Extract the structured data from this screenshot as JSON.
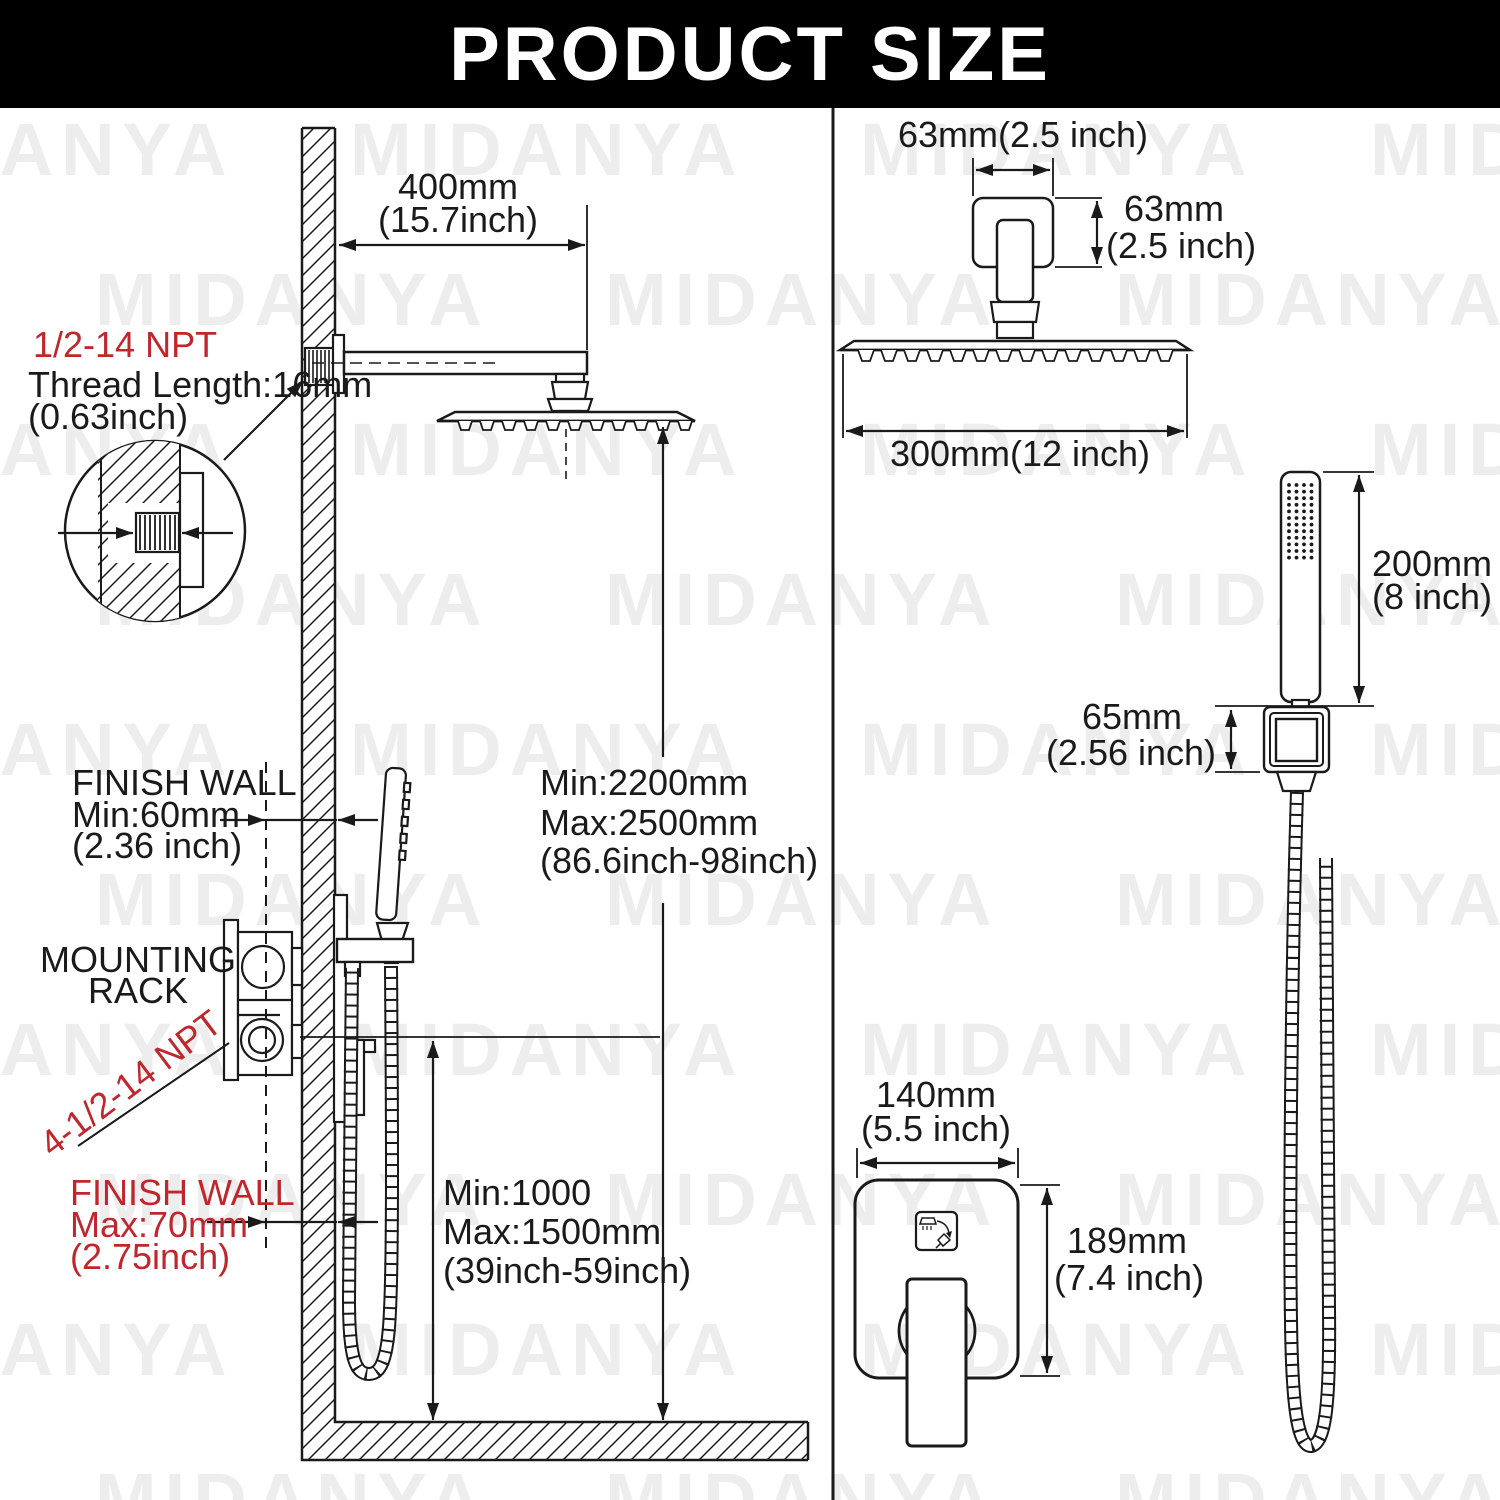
{
  "title": "PRODUCT SIZE",
  "watermark": "MIDANYA",
  "colors": {
    "banner": "#000000",
    "line": "#1a1a1a",
    "red": "#c0272d",
    "watermark": "#ededed"
  },
  "left_panel": {
    "npt_top_label": "1/2-14 NPT",
    "thread_length_line1": "Thread Length:16mm",
    "thread_length_line2": "(0.63inch)",
    "arm_length_line1": "400mm",
    "arm_length_line2": "(15.7inch)",
    "finish_wall_min_line1": "FINISH WALL",
    "finish_wall_min_line2": "Min:60mm",
    "finish_wall_min_line3": "(2.36 inch)",
    "mounting_rack_line1": "MOUNTING",
    "mounting_rack_line2": "RACK",
    "npt_bottom_label": "4-1/2-14 NPT",
    "finish_wall_max_line1": "FINISH WALL",
    "finish_wall_max_line2": "Max:70mm",
    "finish_wall_max_line3": "(2.75inch)",
    "head_height_line1": "Min:2200mm",
    "head_height_line2": "Max:2500mm",
    "head_height_line3": "(86.6inch-98inch)",
    "valve_height_line1": "Min:1000",
    "valve_height_line2": "Max:1500mm",
    "valve_height_line3": "(39inch-59inch)"
  },
  "right_panel": {
    "head_top_width": "63mm(2.5 inch)",
    "head_arm_height_line1": "63mm",
    "head_arm_height_line2": "(2.5 inch)",
    "head_width": "300mm(12 inch)",
    "wand_length_line1": "200mm",
    "wand_length_line2": "(8 inch)",
    "holder_size_line1": "65mm",
    "holder_size_line2": "(2.56 inch)",
    "trim_width_line1": "140mm",
    "trim_width_line2": "(5.5 inch)",
    "trim_height_line1": "189mm",
    "trim_height_line2": "(7.4 inch)"
  }
}
